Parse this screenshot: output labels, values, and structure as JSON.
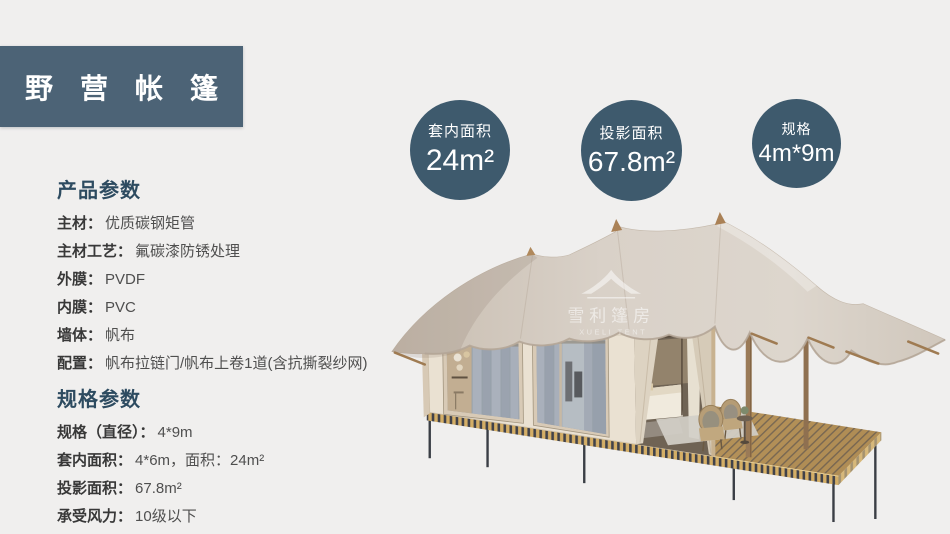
{
  "page": {
    "background_color": "#f0efee",
    "accent_color": "#3e5a6d",
    "banner_color": "#4c6376",
    "heading_color": "#2d4b60"
  },
  "header": {
    "title": "野营帐篷"
  },
  "badges": [
    {
      "label": "套内面积",
      "value": "24m²"
    },
    {
      "label": "投影面积",
      "value": "67.8m²"
    },
    {
      "label": "规格",
      "value": "4m*9m"
    }
  ],
  "product_params": {
    "heading": "产品参数",
    "items": [
      {
        "label": "主材：",
        "value": "优质碳钢矩管"
      },
      {
        "label": "主材工艺：",
        "value": "氟碳漆防锈处理"
      },
      {
        "label": "外膜：",
        "value": "PVDF"
      },
      {
        "label": "内膜：",
        "value": "PVC"
      },
      {
        "label": "墙体：",
        "value": "帆布"
      },
      {
        "label": "配置：",
        "value": "帆布拉链门/帆布上卷1道(含抗撕裂纱网)"
      }
    ]
  },
  "spec_params": {
    "heading": "规格参数",
    "items": [
      {
        "label": "规格（直径）：",
        "value": "4*9m"
      },
      {
        "label": "套内面积：",
        "value": "4*6m，面积：24m²"
      },
      {
        "label": "投影面积：",
        "value": "67.8m²"
      },
      {
        "label": "承受风力：",
        "value": "10级以下"
      }
    ]
  },
  "watermark": {
    "brand": "雪利篷房",
    "brand_en": "XUELI TENT"
  }
}
